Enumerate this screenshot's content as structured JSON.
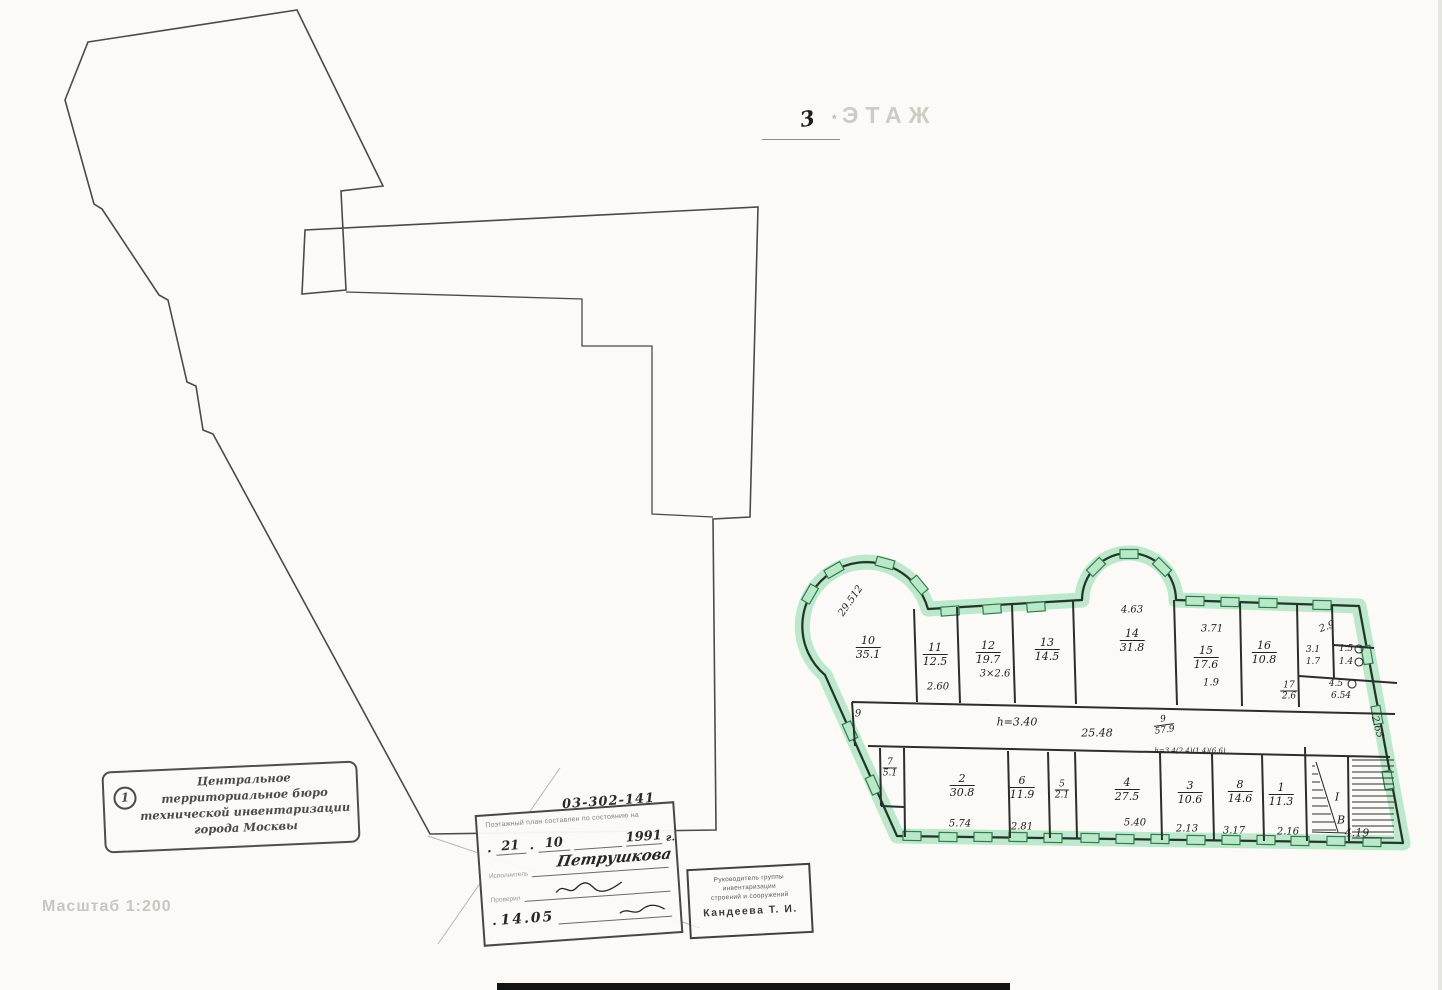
{
  "title": {
    "floor_number": "3",
    "floor_word": "ЭТАЖ",
    "mark": "*"
  },
  "scale_label": "Масштаб 1:200",
  "left_stamp": {
    "badge": "1",
    "line1": "Центральное",
    "line2": "территориальное бюро",
    "line3": "технической инвентаризации",
    "line4": "города Москвы"
  },
  "form": {
    "code": "03-302-141",
    "header": "Поэтажный план составлен по состоянию на",
    "sep": ".",
    "day": "21",
    "month": "10",
    "year": "1991",
    "year_suffix": "г.",
    "executor_label": "Исполнитель",
    "executor_name": "Петрушкова",
    "checker_label": "Проверил",
    "bottom_date": "14.05"
  },
  "right_stamp": {
    "line1": "Руководитель группы",
    "line2": "инвентаризации",
    "line3": "строений и сооружений",
    "name": "Кандеева Т. И."
  },
  "plan": {
    "rooms": [
      {
        "number": "10",
        "area": "35.1"
      },
      {
        "number": "11",
        "area": "12.5"
      },
      {
        "number": "12",
        "area": "19.7"
      },
      {
        "number": "13",
        "area": "14.5"
      },
      {
        "number": "14",
        "area": "31.8"
      },
      {
        "number": "15",
        "area": "17.6"
      },
      {
        "number": "16",
        "area": "10.8"
      },
      {
        "number": "17",
        "area": "2.6"
      },
      {
        "number": "7",
        "area": "5.1"
      },
      {
        "number": "2",
        "area": "30.8"
      },
      {
        "number": "6",
        "area": "11.9"
      },
      {
        "number": "5",
        "area": "2.1"
      },
      {
        "number": "4",
        "area": "27.5"
      },
      {
        "number": "3",
        "area": "10.6"
      },
      {
        "number": "8",
        "area": "14.6"
      },
      {
        "number": "1",
        "area": "11.3"
      },
      {
        "number": "9",
        "area": "57.9"
      }
    ],
    "dims": {
      "tower": "29.512",
      "r11": "2.60",
      "r12": "3×2.6",
      "r14_top": "4.63",
      "r15_top": "3.71",
      "r15_bot": "1.9",
      "cluster_top": "2.9",
      "cluster_w1": "3.1",
      "cluster_w2": "1.7",
      "wc1": "1.5",
      "wc2": "1.4",
      "strip1": "4.5",
      "strip2": "6.54",
      "corridor_len": "25.48",
      "corridor_tick": "9",
      "height": "h=3.40",
      "wall_note": "h=3.4(2.4)(1.4)(6.6)",
      "r2": "5.74",
      "r6": "2.81",
      "r4": "5.40",
      "r3": "2.13",
      "r8": "3.17",
      "r1": "2.16",
      "stair": "4.19",
      "stair_diag": "2.65",
      "stair_letter": "В",
      "stair_roman": "I"
    }
  },
  "colors": {
    "highlight_green": "#b5e6c6",
    "line_green": "#3da266",
    "ink": "#2d2d2d",
    "faint": "#c7c7c0"
  }
}
